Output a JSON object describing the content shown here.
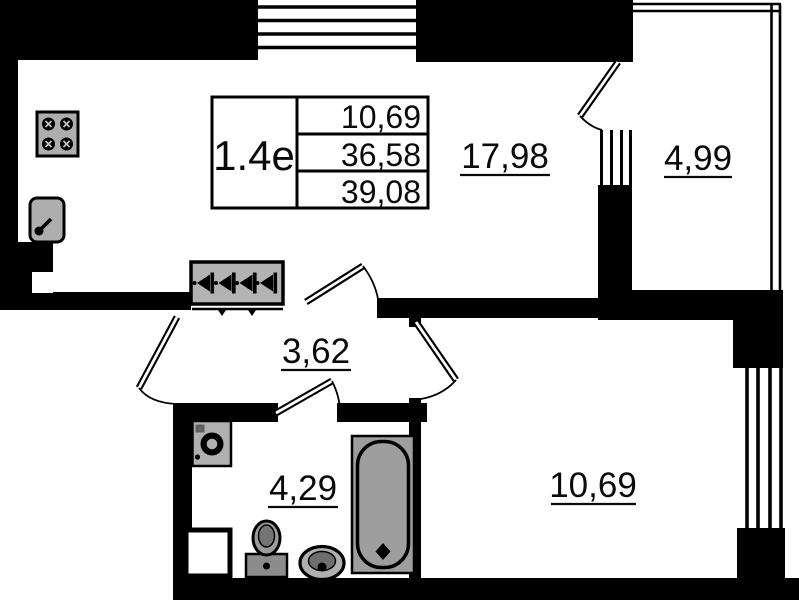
{
  "plan": {
    "unit_label": "1.4e",
    "title_block": {
      "row1": "10,69",
      "row2": "36,58",
      "row3": "39,08"
    },
    "rooms": {
      "kitchen_living": "17,98",
      "balcony": "4,99",
      "hallway": "3,62",
      "bathroom": "4,29",
      "bedroom": "10,69"
    },
    "fixtures": [
      "stove-icon",
      "kitchen-sink-icon",
      "wardrobe-hangers-icon",
      "washing-machine-icon",
      "toilet-icon",
      "bathroom-sink-icon",
      "bathtub-icon"
    ],
    "colors": {
      "wall": "#000000",
      "background": "#ffffff",
      "fixture_fill": "#aeaeae"
    }
  }
}
